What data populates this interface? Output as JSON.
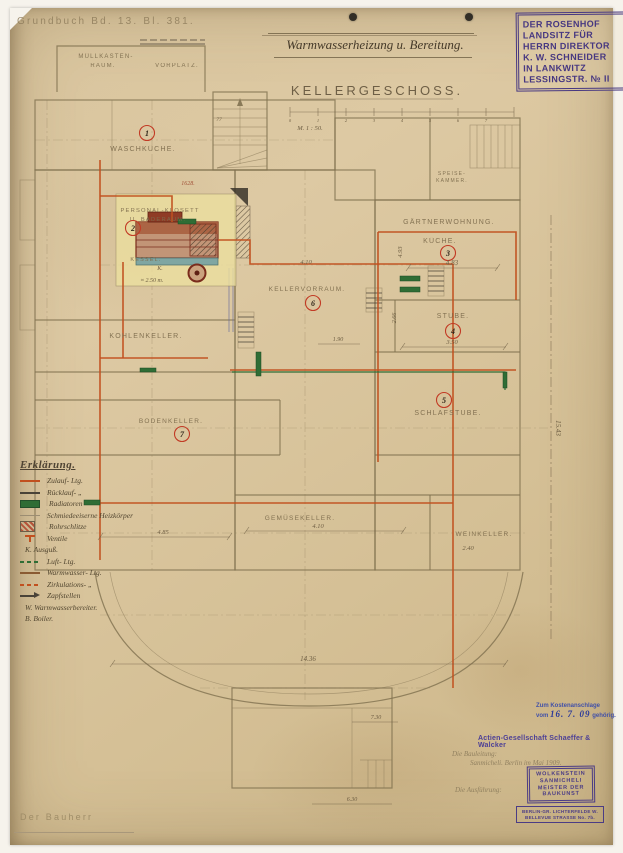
{
  "colors": {
    "paper": "#d8c39a",
    "pipe_red": "#c1501f",
    "radiator_green": "#2f6d35",
    "stamp_purple": "#463781",
    "stamp_blue": "#3c4aa5",
    "pencil": "#80704f"
  },
  "header": {
    "grundbuch": "Grundbuch Bd. 13. Bl. 381.",
    "title": "Warmwasserheizung u. Bereitung."
  },
  "plan": {
    "heading": "Kellergeschoss.",
    "scale_note": "M. 1 : 50.",
    "scale_ticks": [
      "0",
      "1",
      "2",
      "3",
      "4",
      "5",
      "6",
      "7"
    ],
    "rooms": {
      "waschkueche": {
        "num": "1",
        "label": "Waschküche."
      },
      "baderaum": {
        "num": "2",
        "line1": "Personal-Klosett",
        "line2": "u. Baderaum."
      },
      "gaertner": {
        "num": "3",
        "line1": "Gärtnerwohnung.",
        "line2": "Küche."
      },
      "stube": {
        "num": "4",
        "label": "Stube."
      },
      "schlafstube": {
        "num": "5",
        "label": "Schlafstube."
      },
      "vorraum": {
        "num": "6",
        "label": "Kellervorraum."
      },
      "bodenkeller": {
        "num": "7",
        "label": "Bodenkeller."
      },
      "kohlenkeller": {
        "label": "Kohlenkeller."
      },
      "gemuese": {
        "label": "Gemüsekeller."
      },
      "wein": {
        "label": "Weinkeller."
      },
      "muell": {
        "line1": "Müllkasten-",
        "line2": "Raum."
      },
      "vorplatz": {
        "label": "Vorplatz."
      },
      "speise": {
        "line1": "Speise-",
        "line2": "Kammer."
      }
    },
    "boiler": {
      "label": "Kessel.",
      "mark": "K.",
      "width_note": "≈ 2.50 m."
    },
    "dims": {
      "kueche_w": "4.83",
      "kueche_h": "4.93",
      "stube_w": "3.50",
      "stube_h": "2.66",
      "vorraum": "4.10",
      "vorraum_small": "1.90",
      "gemuese": "4.10",
      "wein": "2.40",
      "left": "4.85",
      "right_total": "15.43",
      "terrace": "14.36",
      "annex": "7.30",
      "annex2": "6.30",
      "stair": "77",
      "plot_no": "1628."
    }
  },
  "legend": {
    "title": "Erklärung.",
    "items": [
      {
        "swatch": "line-red",
        "label": "Zulauf- Ltg."
      },
      {
        "swatch": "line-dark",
        "label": "Rücklauf-  „"
      },
      {
        "swatch": "bar-green",
        "label": "Radiatoren"
      },
      {
        "swatch": "line-faint",
        "label": "Schmiedeeiserne Heizkörper"
      },
      {
        "swatch": "box-hatch",
        "label": "Rohrschlitze"
      },
      {
        "swatch": "valve",
        "label": "Ventile"
      },
      {
        "swatch": "none",
        "label": "K. Ausguß."
      },
      {
        "swatch": "dash-green",
        "label": "Luft- Ltg."
      },
      {
        "swatch": "line-sepia",
        "label": "Warmwasser- Ltg."
      },
      {
        "swatch": "dash-red",
        "label": "Zirkulations-  „"
      },
      {
        "swatch": "arrow",
        "label": "Zapfstellen"
      },
      {
        "swatch": "none",
        "label": "W. Warmwasserbereiter."
      },
      {
        "swatch": "none",
        "label": "B. Boiler."
      }
    ]
  },
  "stamps": {
    "rosenhof": {
      "lines": [
        "DER ROSENHOF",
        "LANDSITZ FÜR",
        "HERRN DIREKTOR",
        "K. W. SCHNEIDER",
        "IN LANKWITZ",
        "LESSINGSTR. № II"
      ]
    },
    "kosten": {
      "line1": "Zum Kostenanschlage",
      "prefix": "vom",
      "date": "16. 7. 09",
      "suffix": "gehörig."
    },
    "company": "Actien-Gesellschaft Schaeffer & Walcker",
    "wolkenstein": {
      "lines": [
        "WOLKENSTEIN",
        "SANMICHELI",
        "MEISTER DER",
        "BAUKUNST"
      ]
    },
    "address": {
      "line1": "BERLIN-GR. LICHTERFELDE W.",
      "line2": "BELLEVUE STRASSE No. 7b."
    }
  },
  "signatures": {
    "bauherr": "Der Bauherr",
    "note1": "Die Bauleitung:",
    "note2": "Sanmicheli.  Berlin im Mai 1909.",
    "note3": "Die Ausführung:"
  }
}
